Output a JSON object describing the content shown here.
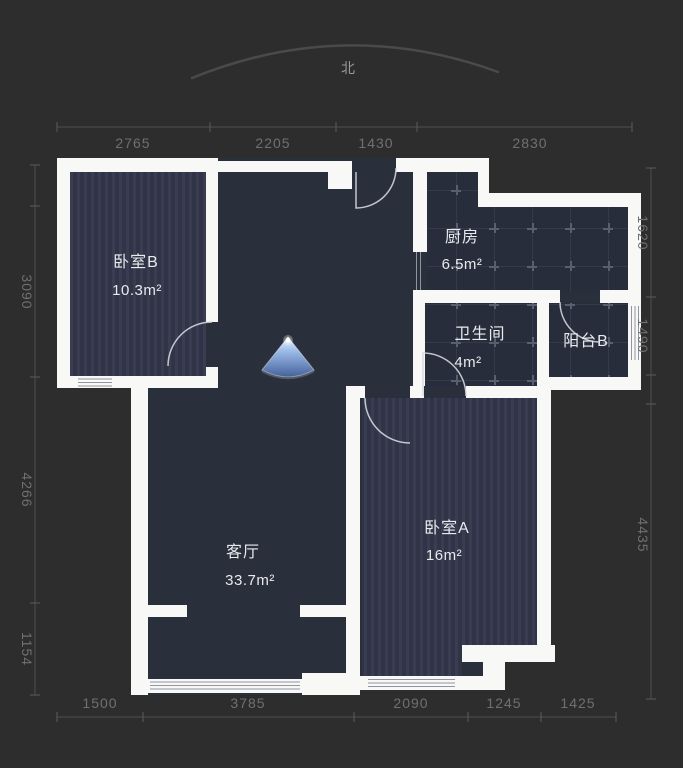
{
  "compass": {
    "north_label": "北"
  },
  "dimensions": {
    "top": [
      "2765",
      "2205",
      "1430",
      "2830"
    ],
    "bottom": [
      "1500",
      "3785",
      "2090",
      "1245",
      "1425"
    ],
    "left": [
      "3090",
      "4266",
      "1154"
    ],
    "right": [
      "1620",
      "1490",
      "4435"
    ]
  },
  "rooms": {
    "bedroom_b": {
      "name": "卧室B",
      "area": "10.3m²"
    },
    "kitchen": {
      "name": "厨房",
      "area": "6.5m²"
    },
    "bathroom": {
      "name": "卫生间",
      "area": "4m²"
    },
    "balcony_b": {
      "name": "阳台B"
    },
    "living": {
      "name": "客厅",
      "area": "33.7m²"
    },
    "bedroom_a": {
      "name": "卧室A",
      "area": "16m²"
    }
  },
  "colors": {
    "background": "#2d2d2d",
    "floor": "#2a2f3c",
    "wall": "#f8f8f6",
    "dimension_text": "#707070",
    "room_text": "#e8eaed",
    "viewpoint_blue": "#9cbbe8"
  }
}
